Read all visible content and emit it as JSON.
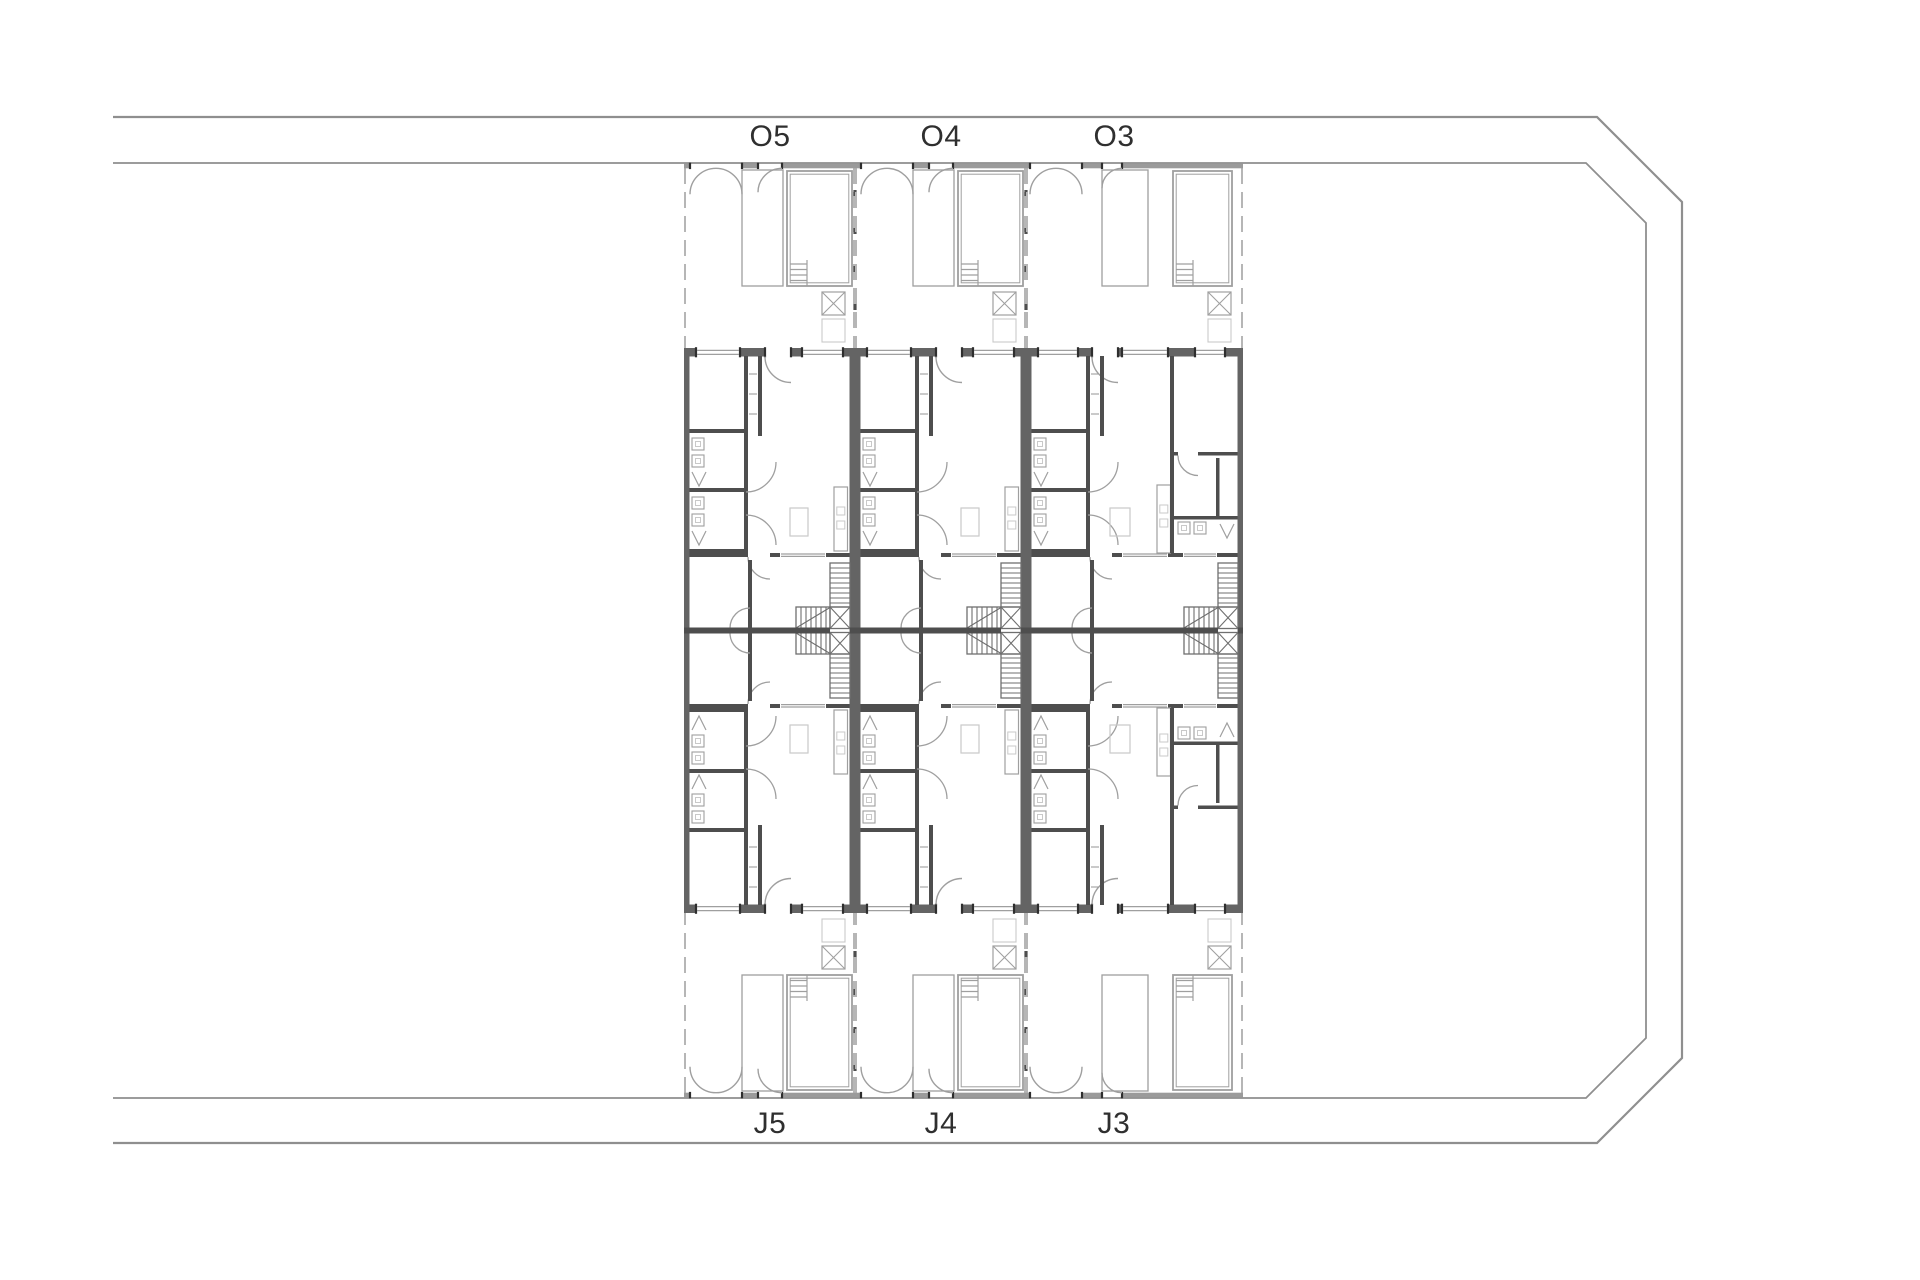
{
  "canvas": {
    "width": 1920,
    "height": 1280,
    "background": "#ffffff"
  },
  "site": {
    "boundary_outer": [
      [
        113,
        117
      ],
      [
        1597,
        117
      ],
      [
        1682,
        202
      ],
      [
        1682,
        1058
      ],
      [
        1597,
        1143
      ],
      [
        113,
        1143
      ]
    ],
    "boundary_inner": [
      [
        113,
        163
      ],
      [
        1586,
        163
      ],
      [
        1646,
        223
      ],
      [
        1646,
        1038
      ],
      [
        1586,
        1098
      ],
      [
        113,
        1098
      ]
    ]
  },
  "plan": {
    "mirror_axis_y": 630.5,
    "label_rows": {
      "top_baseline_y": 146,
      "bottom_baseline_y": 1133,
      "font_size": 30
    },
    "columns": [
      {
        "top_label": "O5",
        "bottom_label": "J5",
        "x": 684,
        "width": 171,
        "label_x": 770,
        "variant": "standard"
      },
      {
        "top_label": "O4",
        "bottom_label": "J4",
        "x": 855,
        "width": 171,
        "label_x": 941,
        "variant": "standard"
      },
      {
        "top_label": "O3",
        "bottom_label": "J3",
        "x": 1026,
        "width": 217,
        "label_x": 1114,
        "variant": "wide"
      }
    ],
    "features": {
      "yard": [
        "entry-gate-double-door",
        "planter-court-with-door",
        "lap-pool-with-steps",
        "skylight-x-box",
        "service-box"
      ],
      "house": [
        "bedroom",
        "bathroom-cells",
        "wardrobe",
        "entry-door",
        "living-room",
        "kitchen-counter",
        "table",
        "rear-room",
        "l-shaped-stair"
      ]
    }
  },
  "colors": {
    "background": "#ffffff",
    "boundary": "#8f8f8f",
    "wall_outer": "#646464",
    "wall_dark": "#4e4e4e",
    "wall_light": "#9b9b9b",
    "jamb": "#2e2e2e",
    "line_mid": "#9f9f9f",
    "line_light": "#b6b6b6",
    "line_faint": "#c9c9c9",
    "stair": "#6f6f6f",
    "text": "#2f2f2f"
  }
}
